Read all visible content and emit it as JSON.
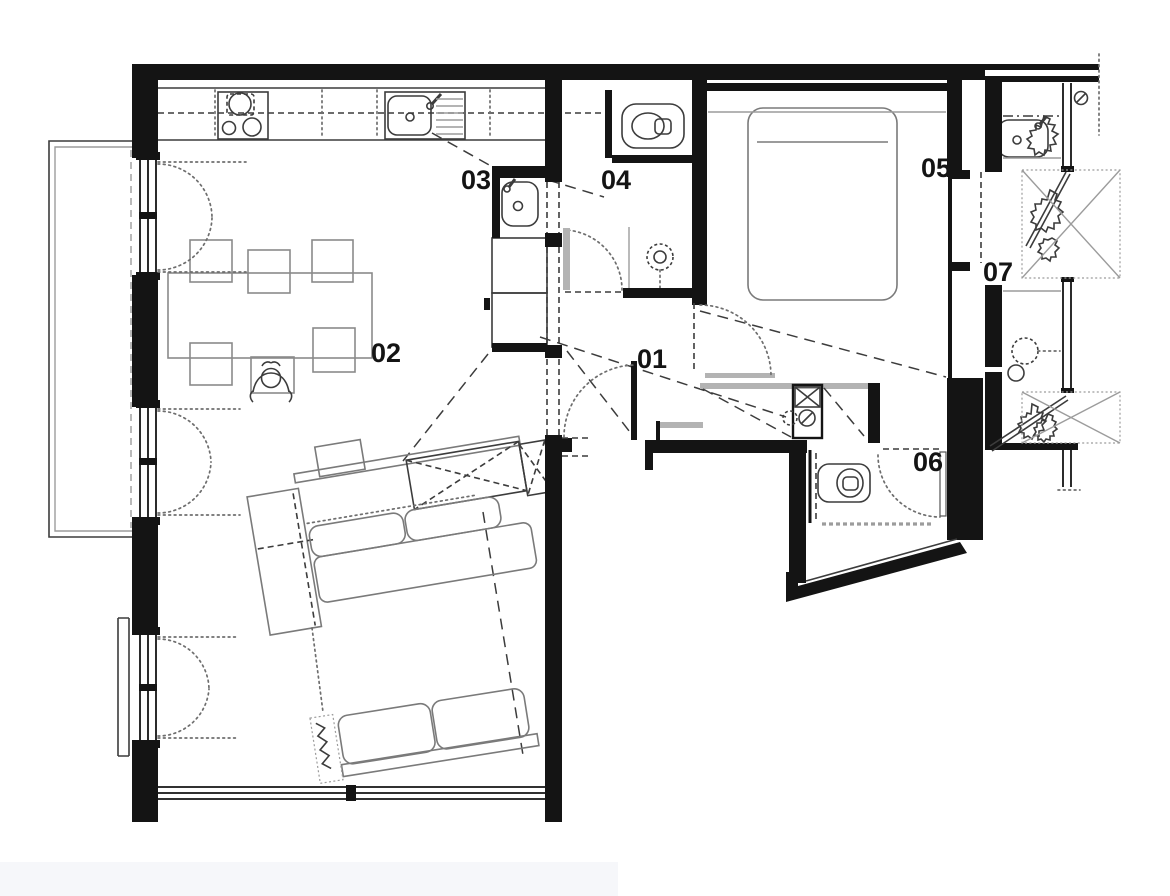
{
  "page": {
    "background": "#ffffff",
    "type": "architectural-floor-plan"
  },
  "rooms": [
    {
      "id": "room-01",
      "label": "01"
    },
    {
      "id": "room-02",
      "label": "02"
    },
    {
      "id": "room-03",
      "label": "03"
    },
    {
      "id": "room-04",
      "label": "04"
    },
    {
      "id": "room-05",
      "label": "05"
    },
    {
      "id": "room-06",
      "label": "06"
    },
    {
      "id": "room-07",
      "label": "07"
    }
  ],
  "fixtures": [
    "cooktop-icon",
    "kitchen-sink-icon",
    "prep-sink-icon",
    "base-cabinet",
    "toilet-icon",
    "shower-head-icon",
    "double-bed",
    "washbasin-icon",
    "washing-machine-icon",
    "dryer-icon",
    "dining-table",
    "chair",
    "person-seated",
    "sofa-sectional",
    "chaise-lounge",
    "storage-box",
    "plant-icon",
    "door-swing",
    "window",
    "balcony",
    "wardrobe-bench"
  ],
  "colors": {
    "wall": "#141414",
    "furniture": "#7a7a7a",
    "detail": "#3c3c3c",
    "light": "#9c9c9c",
    "dotted": "#6e6e6e",
    "band": "#b3b3b3",
    "artifact": "#f6f7fa",
    "background": "#ffffff"
  }
}
